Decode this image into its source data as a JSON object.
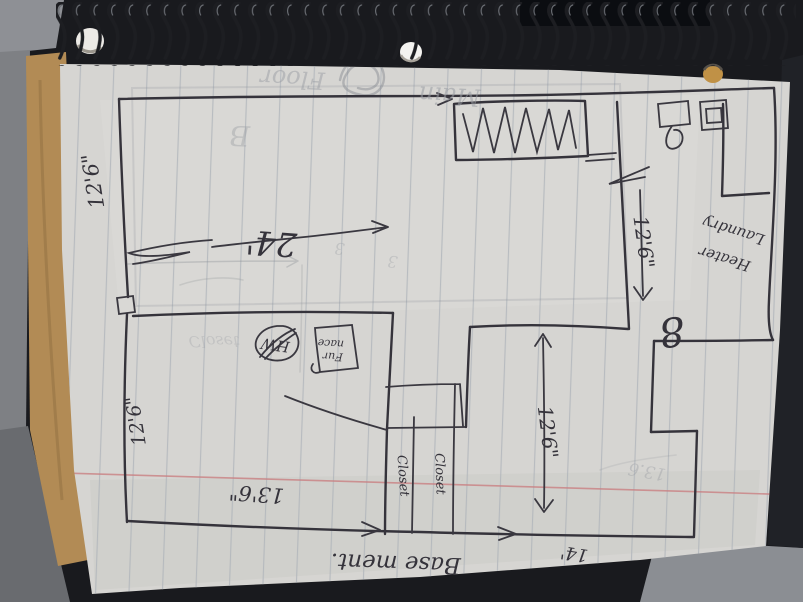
{
  "floor_plan": {
    "room_labels": {
      "basement": "Base ment.",
      "laundry_line1": "Laundry",
      "laundry_line2": "Heater",
      "closet_left": "Closet",
      "closet_right": "Closet"
    },
    "equipment_labels": {
      "water_heater": "HW",
      "furnace_line1": "Fur",
      "furnace_line2": "nace"
    },
    "dimensions": {
      "upper_left_wall": "12'6\"",
      "upper_room_width": "24'",
      "upper_right_wall": "12'6\"",
      "lower_left_wall": "12'6\"",
      "lower_left_room_width": "13'6\"",
      "lower_middle_room_height": "12'6\"",
      "lower_middle_room_width": "14'",
      "right_side": "8"
    },
    "ghost_pencil_text": {
      "main": "Main",
      "floor": "Floor",
      "letter_b": "B",
      "dim_13_6": "13.6",
      "three_a": "3",
      "three_b": "3",
      "closet_bleed": "Closet"
    }
  }
}
